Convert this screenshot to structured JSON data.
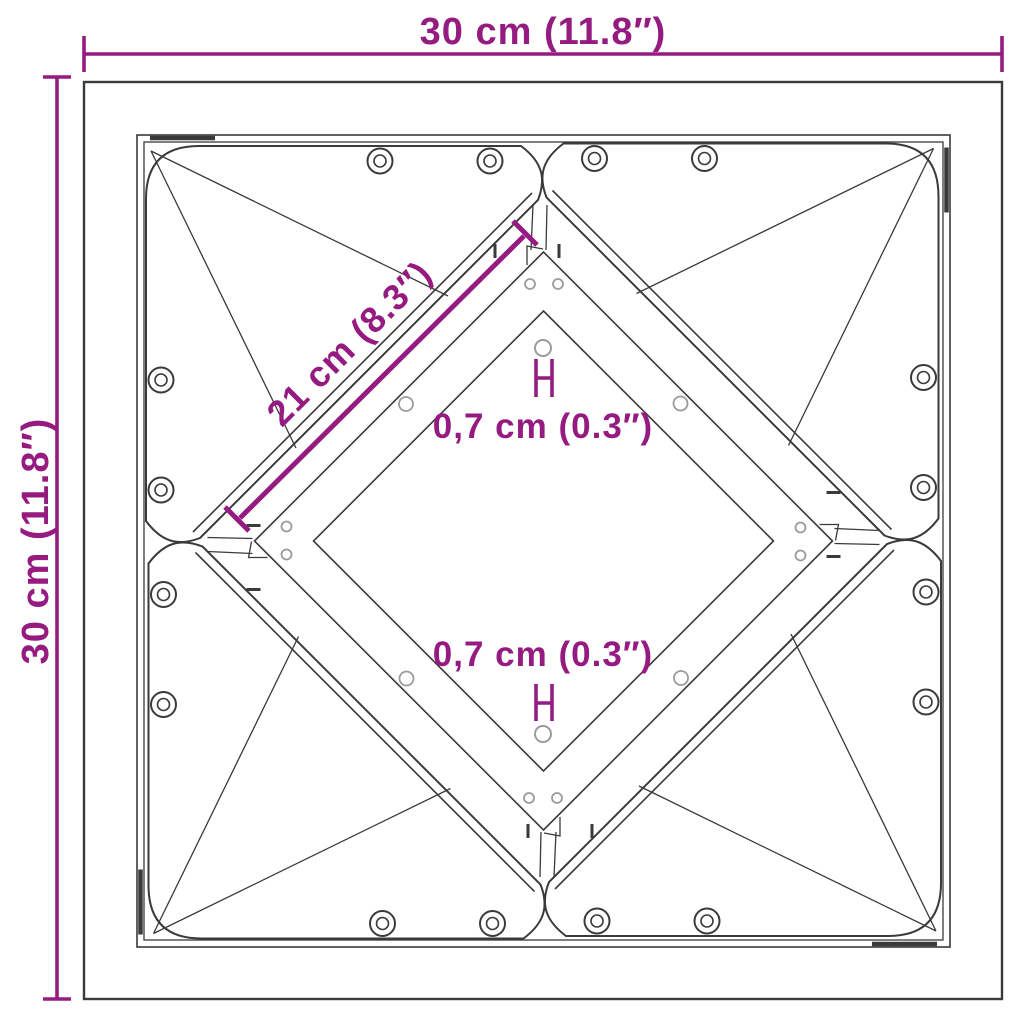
{
  "title": "Square frame dimension diagram",
  "colors": {
    "accent": "#951B81",
    "line": "#3A3A3A",
    "hole": "#9B9B9B",
    "bg": "#FFFFFF"
  },
  "dimensions": {
    "width": {
      "label": "30 cm (11.8″)",
      "value_cm": 30,
      "value_in": 11.8
    },
    "height": {
      "label": "30 cm (11.8″)",
      "value_cm": 30,
      "value_in": 11.8
    },
    "diagonal": {
      "label": "21 cm (8.3″)",
      "value_cm": 21,
      "value_in": 8.3
    },
    "hole_top": {
      "label": "0,7 cm (0.3″)",
      "value_cm": 0.7,
      "value_in": 0.3
    },
    "hole_bottom": {
      "label": "0,7 cm (0.3″)",
      "value_cm": 0.7,
      "value_in": 0.3
    }
  }
}
